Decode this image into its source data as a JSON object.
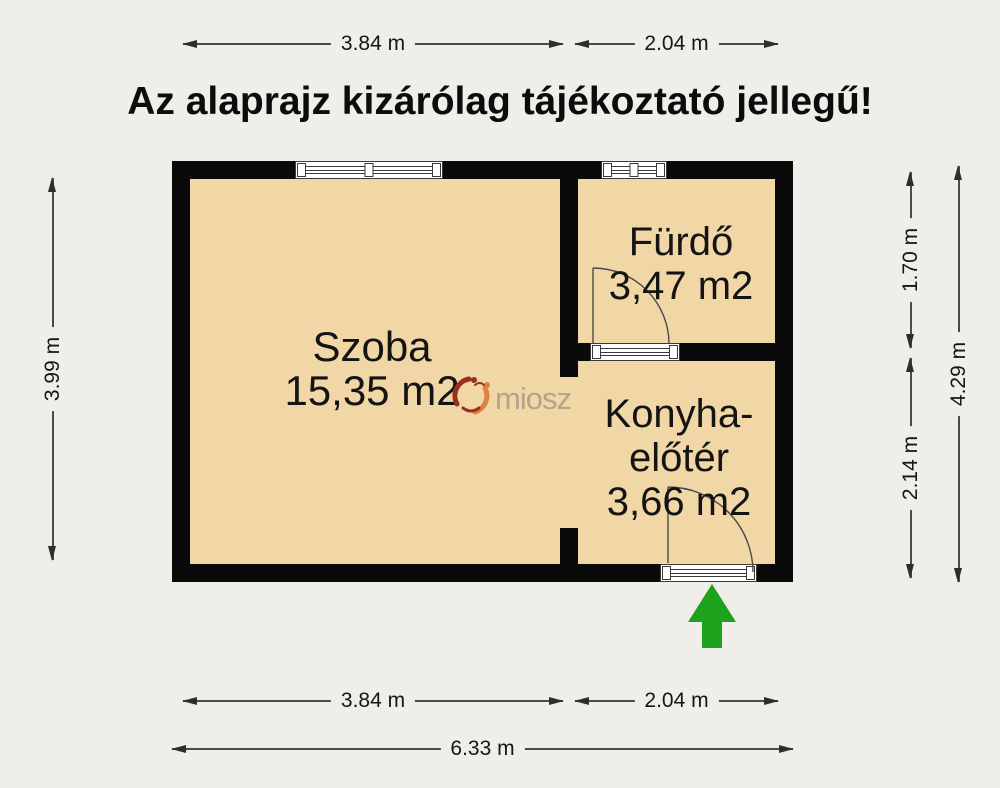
{
  "title": "Az alaprajz kizárólag tájékoztató jellegű!",
  "rooms": {
    "szoba": {
      "name": "Szoba",
      "area": "15,35 m2"
    },
    "furdo": {
      "name": "Fürdő",
      "area": "3,47 m2"
    },
    "konyha": {
      "name_line1": "Konyha-",
      "name_line2": "előtér",
      "area": "3,66 m2"
    }
  },
  "dimensions": {
    "top": {
      "szoba_width": "3.84 m",
      "konyha_width": "2.04 m"
    },
    "bottom": {
      "szoba_width": "3.84 m",
      "konyha_width": "2.04 m",
      "total_width": "6.33 m"
    },
    "left": {
      "szoba_height": "3.99 m"
    },
    "right": {
      "furdo_height": "1.70 m",
      "konyha_height": "2.14 m",
      "total_height": "4.29 m"
    }
  },
  "watermark": {
    "logo_text": "miosz"
  },
  "colors": {
    "background": "#efeee9",
    "floor": "#f2d7a6",
    "wall": "#0a0a0a",
    "dimension_line": "#4a4a4a",
    "text": "#141414",
    "entrance_arrow": "#1da21d",
    "logo_dark_red": "#9b2e1d",
    "logo_orange": "#dc8243",
    "logo_text_color": "#b5a48c"
  }
}
